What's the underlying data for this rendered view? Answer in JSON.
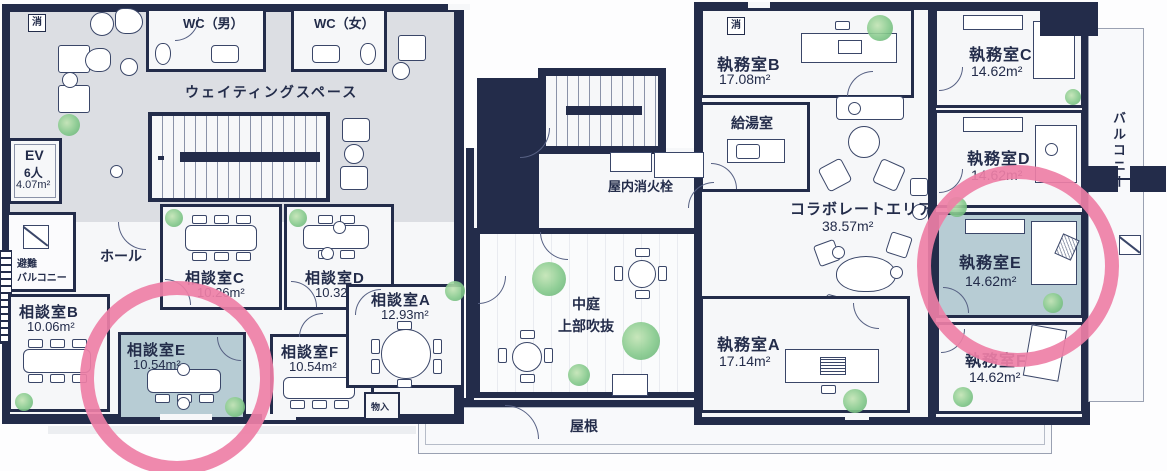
{
  "title": "フロアプラン",
  "colors": {
    "wall": "#232c4a",
    "highlight_room": "#b7ccd4",
    "highlight_ring": "#ee7fa6",
    "waiting_floor": "#dcdee3"
  },
  "icons": {
    "fire_extinguisher": "消"
  },
  "rooms": {
    "wc_male": {
      "label": "WC（男）"
    },
    "wc_female": {
      "label": "WC（女）"
    },
    "waiting": {
      "label": "ウェイティングスペース"
    },
    "elevator": {
      "line1": "EV",
      "line2": "6人",
      "area": "4.07m²"
    },
    "escape_balcony": {
      "line1": "避難",
      "line2": "バルコニー"
    },
    "hall": {
      "label": "ホール"
    },
    "meeting_a": {
      "name": "相談室A",
      "area": "12.93m²"
    },
    "meeting_b": {
      "name": "相談室B",
      "area": "10.06m²"
    },
    "meeting_c": {
      "name": "相談室C",
      "area": "10.26m²"
    },
    "meeting_d": {
      "name": "相談室D",
      "area": "10.32m²"
    },
    "meeting_e": {
      "name": "相談室E",
      "area": "10.54m²",
      "highlighted": true
    },
    "meeting_f": {
      "name": "相談室F",
      "area": "10.54m²"
    },
    "storage": {
      "label": "物入"
    },
    "fire_hydrant": {
      "label": "屋内消火栓"
    },
    "courtyard": {
      "line1": "中庭",
      "line2": "上部吹抜"
    },
    "roof": {
      "label": "屋根"
    },
    "office_b": {
      "name": "執務室B",
      "area": "17.08m²"
    },
    "kitchenette": {
      "label": "給湯室"
    },
    "collaborate": {
      "name": "コラボレートエリア",
      "area": "38.57m²"
    },
    "office_c": {
      "name": "執務室C",
      "area": "14.62m²"
    },
    "office_d": {
      "name": "執務室D",
      "area": "14.62m²"
    },
    "office_e": {
      "name": "執務室E",
      "area": "14.62m²",
      "highlighted": true
    },
    "office_a": {
      "name": "執務室A",
      "area": "17.14m²"
    },
    "office_f": {
      "name": "執務室F",
      "area": "14.62m²"
    },
    "balcony": {
      "label": "バルコニー"
    }
  }
}
